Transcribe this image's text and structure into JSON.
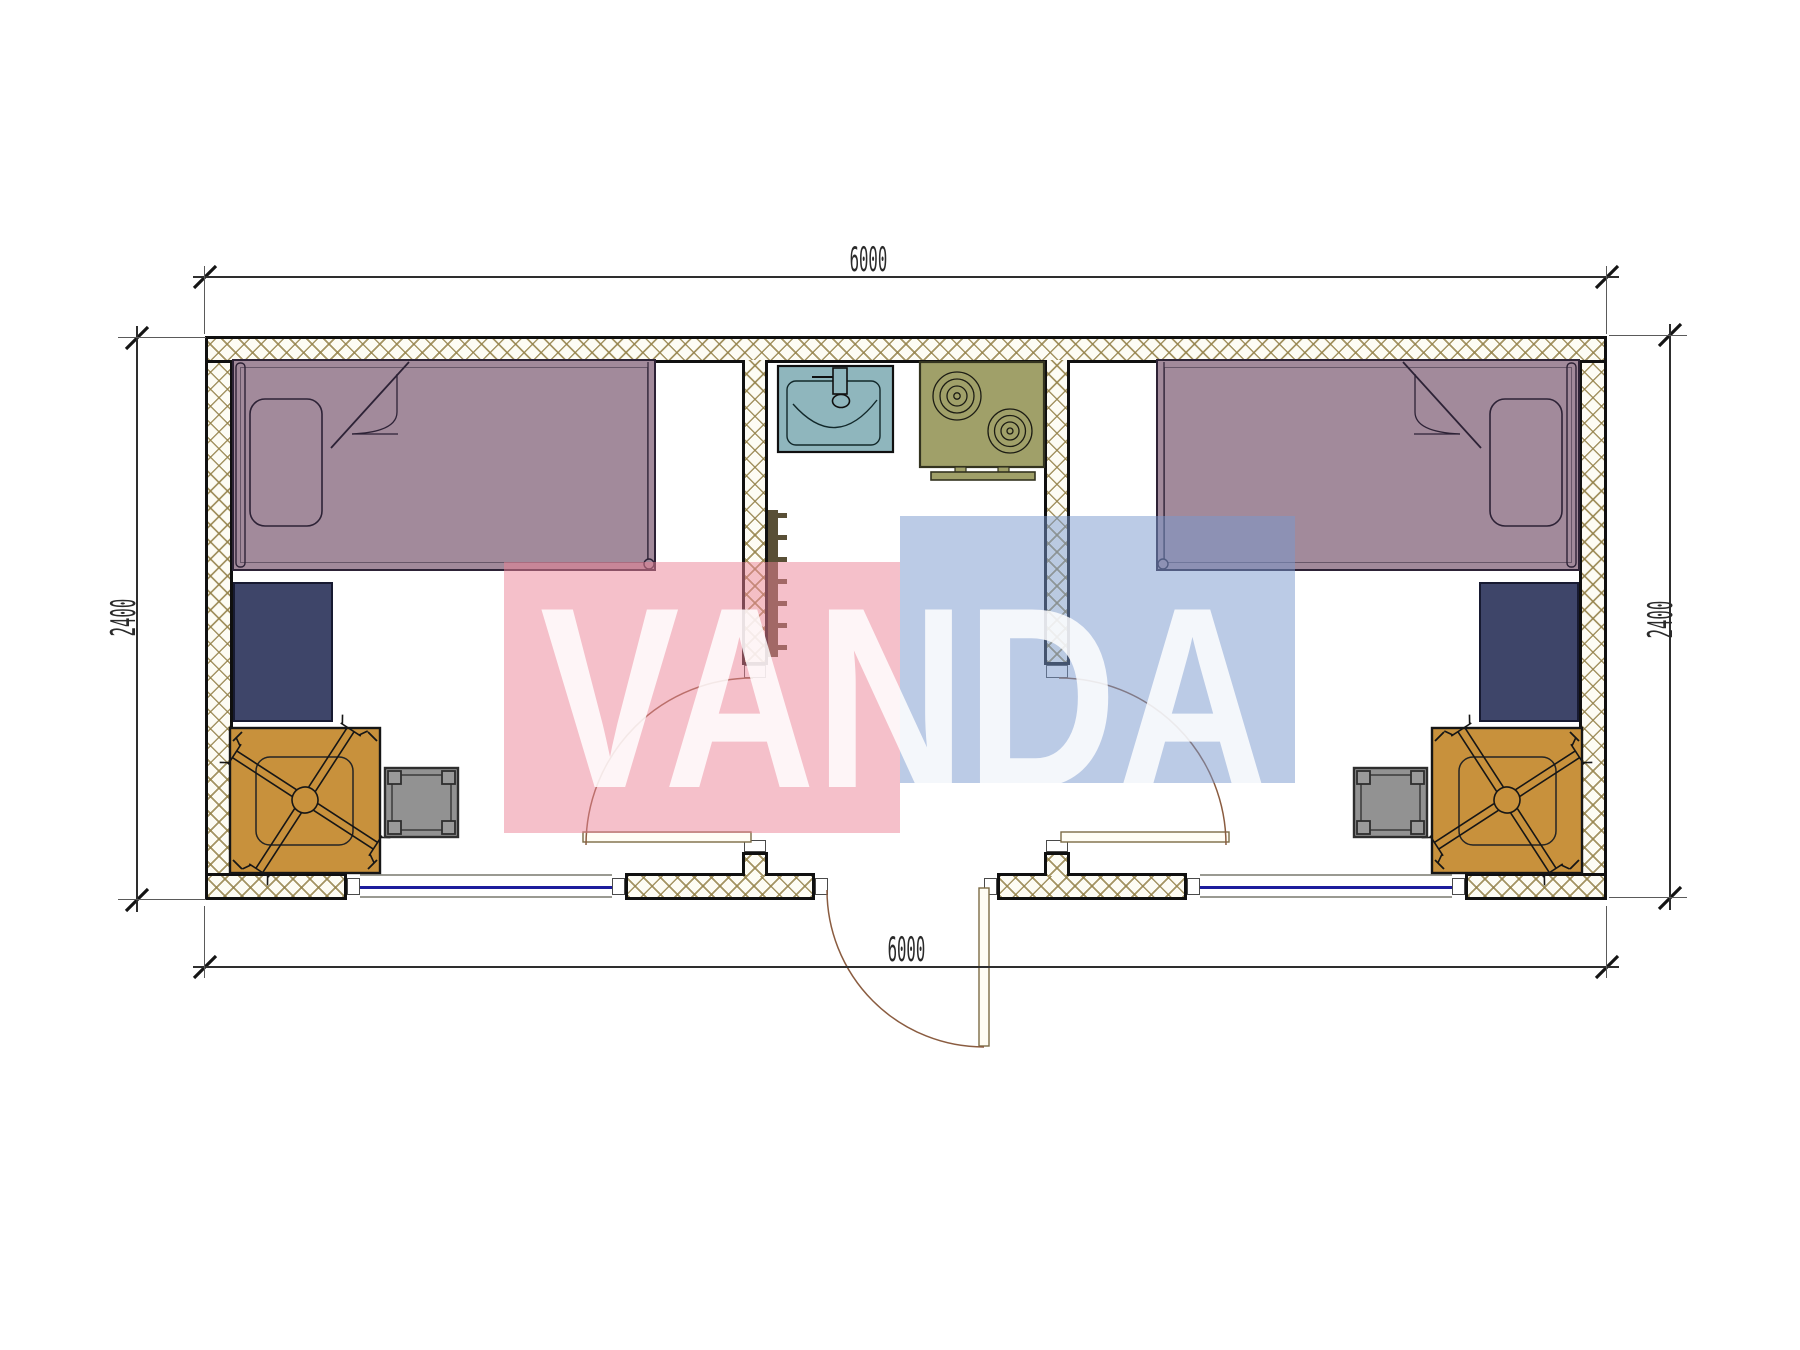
{
  "drawing": {
    "type": "architectural-floor-plan",
    "subject": "twin-room modular cabin 6000 x 2400 with central entry, wash basin and two-burner stove"
  },
  "dimensions": {
    "top": "6000",
    "bottom": "6000",
    "left": "2400",
    "right": "2400"
  },
  "watermark": {
    "text": "VANDA",
    "red_block_color": "#ec8296",
    "blue_block_color": "#7898cd",
    "letter_color": "#ffffff"
  },
  "colors": {
    "wall_border": "#101010",
    "wall_hatch_line": "#94824a",
    "bed_fill": "#a28a9b",
    "bed_outline": "#2d2236",
    "desk_fill": "#3e4569",
    "chair_fill": "#c8913c",
    "stool_fill": "#929292",
    "sink_fill": "#8fb6bd",
    "stove_fill": "#a0a069",
    "radiator_fill": "#42371a",
    "window_glass": "#1c1c9c",
    "door_leaf_line": "#7c6b45",
    "door_swing_arc": "#8a5c40",
    "dimension_line": "#2e2e2e"
  },
  "furniture_icons": [
    "single-bed",
    "pillow",
    "duvet-fold",
    "desk",
    "swivel-chair",
    "stool",
    "wash-basin",
    "two-burner-stove",
    "radiator",
    "entry-door",
    "room-door",
    "window"
  ]
}
